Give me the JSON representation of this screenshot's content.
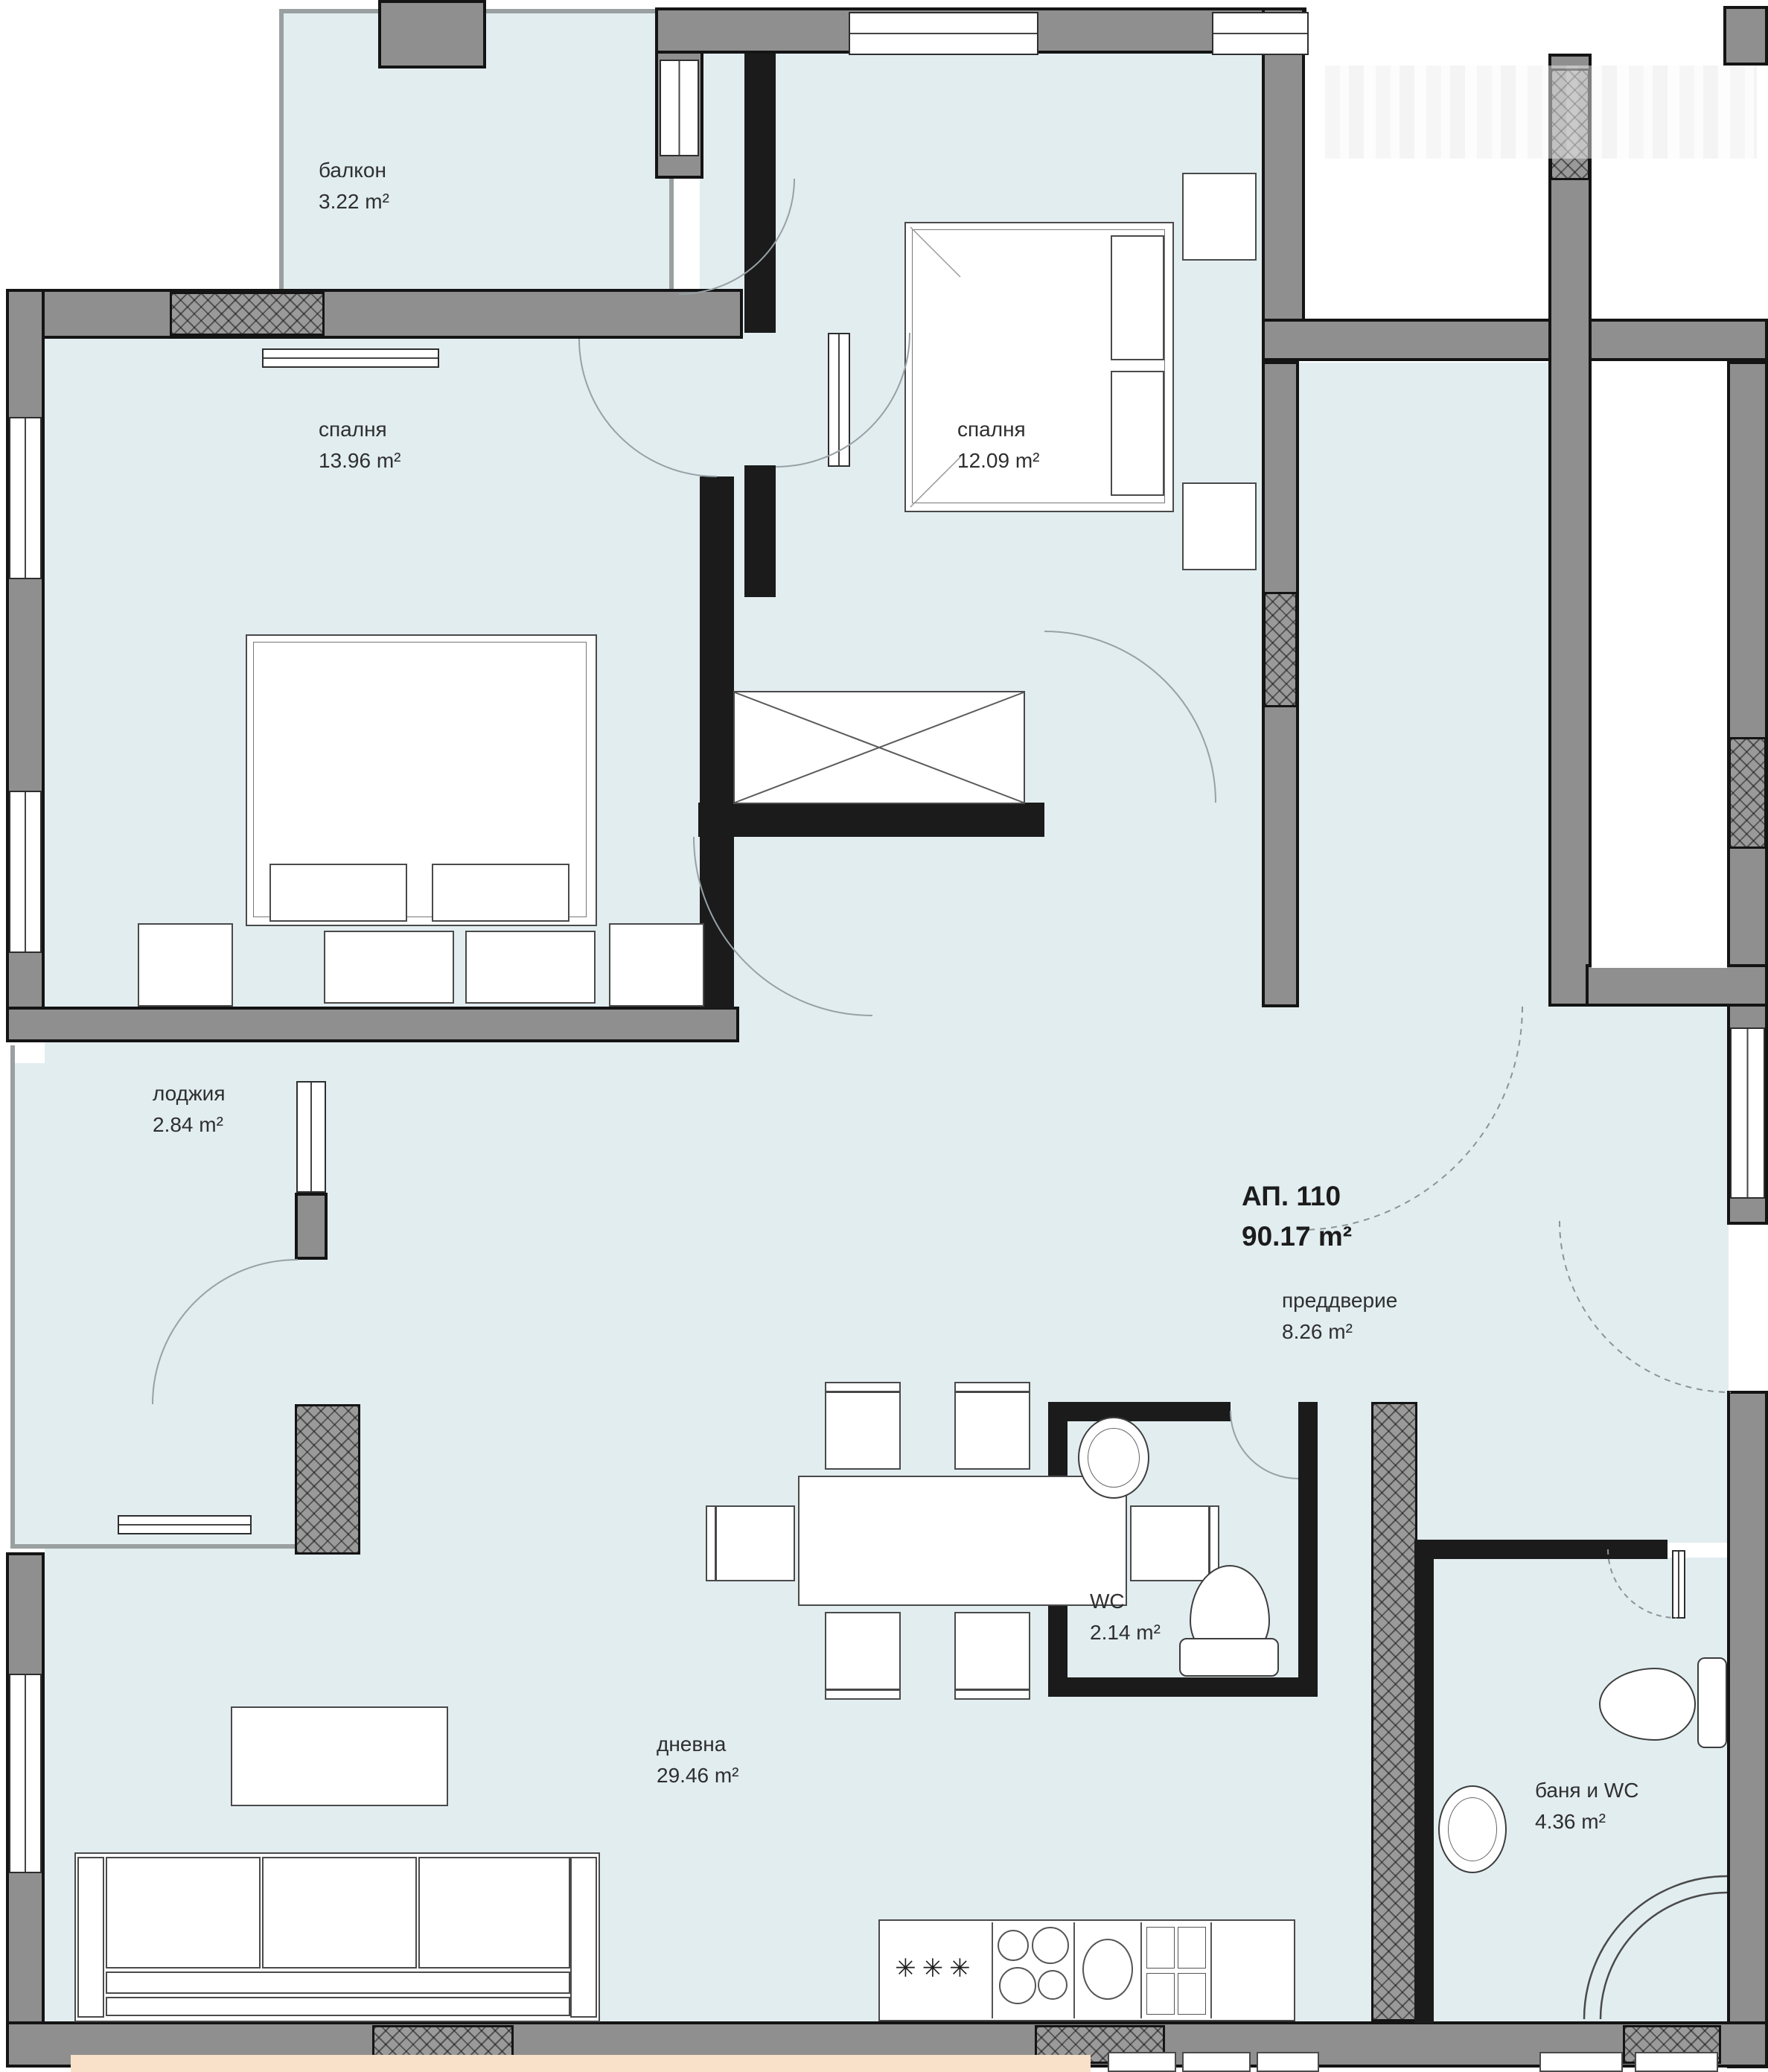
{
  "plan": {
    "apartment": {
      "number": "АП. 110",
      "area": "90.17 m²"
    },
    "rooms": [
      {
        "key": "balcony",
        "name": "балкон",
        "area": "3.22 m²"
      },
      {
        "key": "bedroom-1",
        "name": "спалня",
        "area": "13.96 m²"
      },
      {
        "key": "bedroom-2",
        "name": "спалня",
        "area": "12.09 m²"
      },
      {
        "key": "loggia",
        "name": "лоджия",
        "area": "2.84 m²"
      },
      {
        "key": "entry-hall",
        "name": "преддверие",
        "area": "8.26 m²"
      },
      {
        "key": "wc",
        "name": "WC",
        "area": "2.14 m²"
      },
      {
        "key": "living-room",
        "name": "дневна",
        "area": "29.46 m²"
      },
      {
        "key": "bath-wc",
        "name": "баня и WC",
        "area": "4.36 m²"
      }
    ],
    "kitchen": {
      "freezer_symbol": "✳✳✳"
    },
    "colors": {
      "floor": "#e2edf0",
      "wall_fill": "#8f8f8f",
      "wall_edge": "#141414",
      "bottom_strip": "#f8e1c8",
      "outside": "#ffffff"
    }
  }
}
